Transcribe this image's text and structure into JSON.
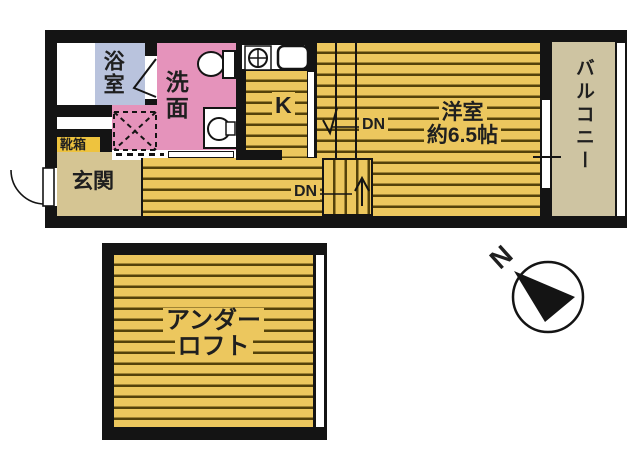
{
  "colors": {
    "wall": "#141414",
    "ink": "#1f1f1f",
    "paper": "#ffffff",
    "floor_yellow": "#ecc75e",
    "floor_stripe": "#54420a",
    "washroom_pink": "#e593bb",
    "bath_blue": "#b9c3dd",
    "entrance_tan": "#d5c593",
    "balcony_tan": "#cec4a2",
    "shoebox_gold": "#eec33e"
  },
  "upper_floor": {
    "bath_label": "浴室",
    "wash_label": "洗面",
    "kitchen_label": "K",
    "stairs_upper_label": "DN",
    "stairs_lower_label": "DN",
    "room_label": "洋室",
    "room_size": "約6.5帖",
    "balcony_label": "バルコニー",
    "entrance_label": "玄関",
    "shoebox_label": "靴箱"
  },
  "lower_floor": {
    "underloft_line1": "アンダー",
    "underloft_line2": "ロフト"
  },
  "compass": {
    "north": "N"
  }
}
